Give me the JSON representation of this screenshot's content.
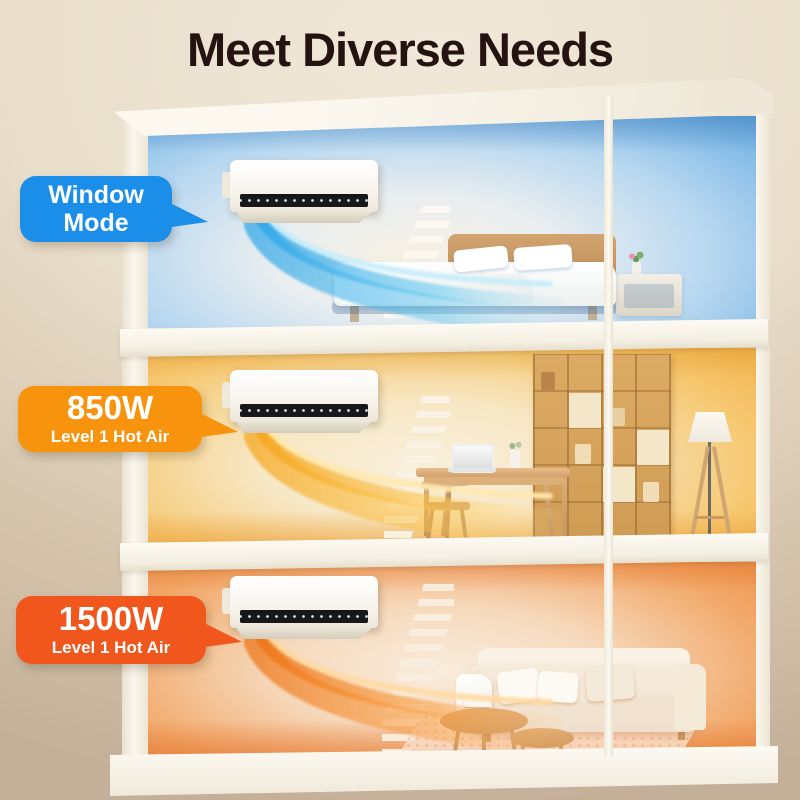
{
  "title": "Meet Diverse Needs",
  "callouts": {
    "cool": {
      "line1": "Window",
      "line2": "Mode",
      "color": "#1a8ee9"
    },
    "mid": {
      "power": "850W",
      "sub": "Level 1 Hot Air",
      "color": "#f7930d"
    },
    "high": {
      "power": "1500W",
      "sub": "Level 1 Hot Air",
      "color": "#f1561d"
    }
  },
  "scene": {
    "floors": [
      {
        "name": "bedroom-cool-air",
        "airflow_color": "#2fa6e8"
      },
      {
        "name": "study-warm-air",
        "airflow_color": "#f6a51c"
      },
      {
        "name": "living-room-hot-air",
        "airflow_color": "#ee7315"
      }
    ]
  }
}
